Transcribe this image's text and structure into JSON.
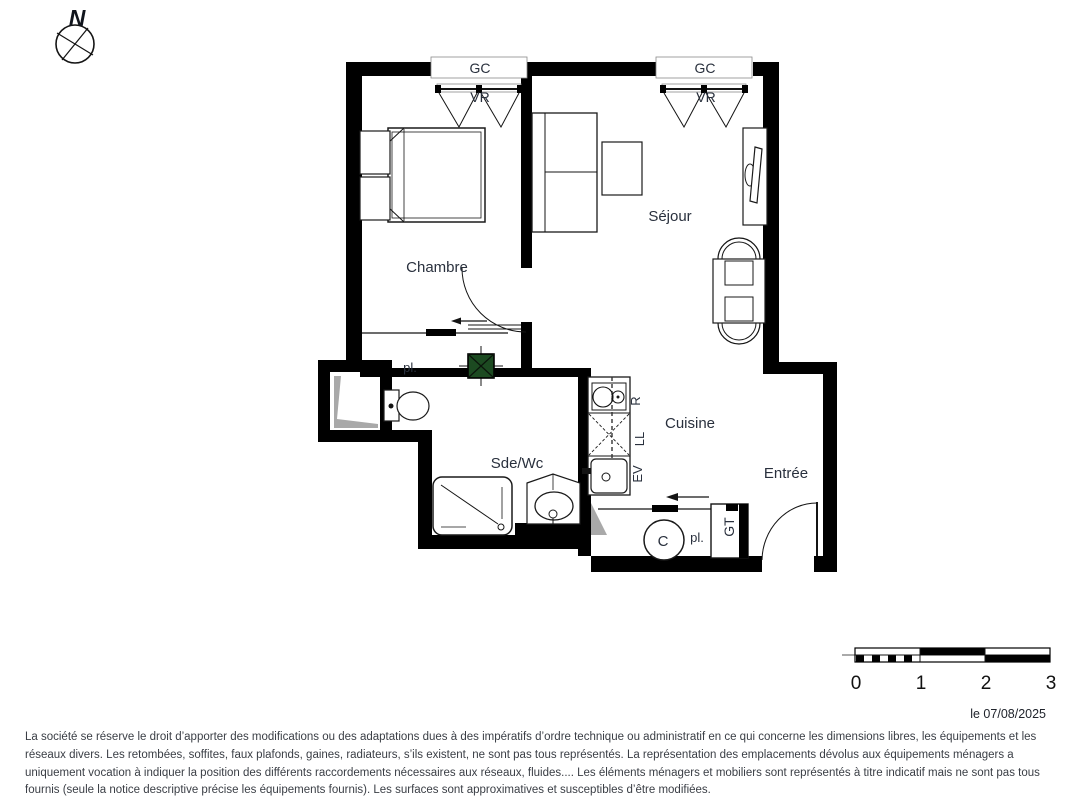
{
  "compass": {
    "north": "N"
  },
  "floor_plan": {
    "windows": [
      {
        "lintel": "GC",
        "shutter": "VR"
      },
      {
        "lintel": "GC",
        "shutter": "VR"
      }
    ],
    "rooms": {
      "bedroom": "Chambre",
      "living": "Séjour",
      "kitchen": "Cuisine",
      "bathroom": "Sde/Wc",
      "entry": "Entrée"
    },
    "annotations": {
      "closet_bedroom": "pl.",
      "closet_entry": "pl.",
      "cooktop": "R",
      "washing_machine": "LL",
      "sink": "EV",
      "technical_duct": "GT",
      "water_heater": "C"
    },
    "colors": {
      "wall": "#000000",
      "duct_box_green": "#1c4a21",
      "shaft_shading": "#a9a9a9",
      "label_text": "#29303d"
    }
  },
  "scale_bar": {
    "unit_labels": [
      "0",
      "1",
      "2",
      "3"
    ]
  },
  "footer": {
    "date": "le 07/08/2025",
    "disclaimer": "La société se réserve le droit d’apporter des modifications ou des adaptations dues à des impératifs d’ordre technique ou administratif en ce qui concerne les dimensions libres, les équipements et les réseaux divers. Les retombées, soffites, faux plafonds, gaines, radiateurs, s’ils existent, ne sont pas tous représentés. La représentation des emplacements dévolus aux équipements ménagers a uniquement vocation à indiquer la position des différents raccordements nécessaires aux réseaux, fluides.... Les éléments ménagers et mobiliers sont représentés à titre indicatif mais ne sont pas tous fournis (seule la notice descriptive précise les équipements fournis). Les surfaces sont approximatives et susceptibles d’être modifiées."
  }
}
